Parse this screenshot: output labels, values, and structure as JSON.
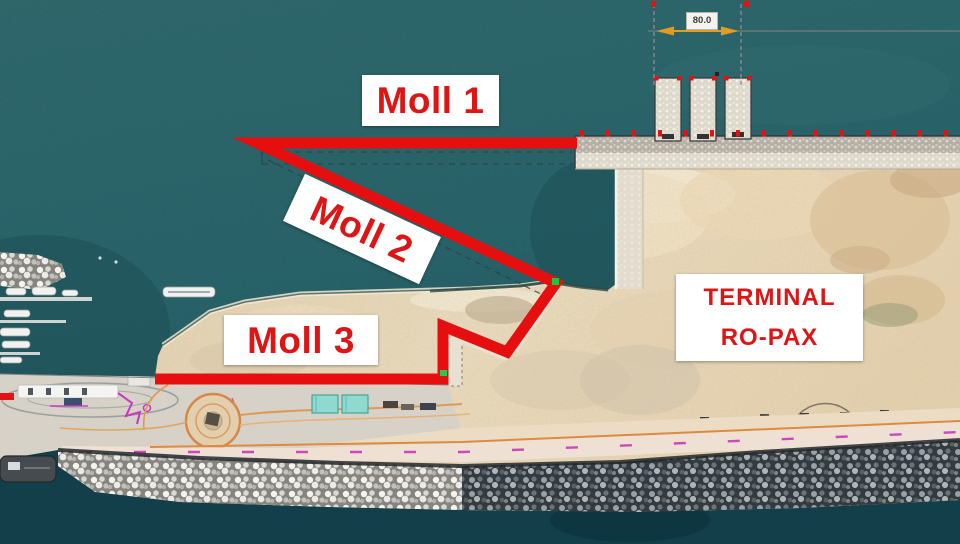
{
  "map": {
    "title": "Port aerial plan with quay annotations",
    "view": "satellite-aerial"
  },
  "annotations": {
    "moll1": "Moll 1",
    "moll2": "Moll 2",
    "moll3": "Moll 3",
    "terminal_line1": "TERMINAL",
    "terminal_line2": "RO-PAX",
    "dimension": "80.0"
  },
  "colors": {
    "annotation-red": "#e60f0f",
    "label-text-red": "#df1515",
    "label-bg": "#ffffff",
    "sea": "#2a5f63",
    "sand": "#e7d6b7",
    "dimension-orange": "#e29c1e"
  }
}
